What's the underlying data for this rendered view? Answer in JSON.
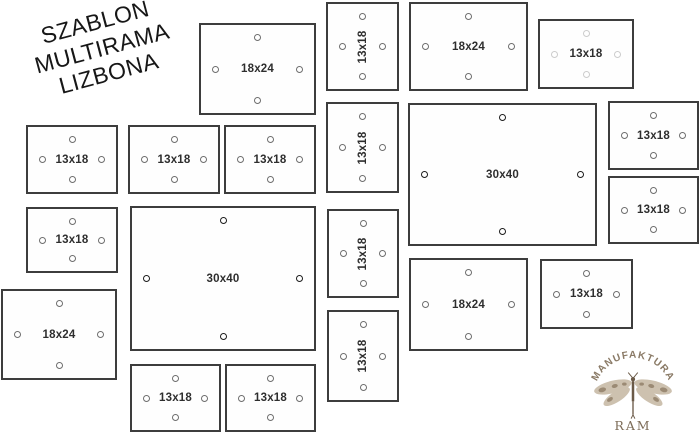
{
  "title": {
    "lines": [
      "SZABLON",
      "MULTIRAMA",
      "LIZBONA"
    ]
  },
  "frames": [
    {
      "id": "A",
      "label": "18x24",
      "x": 199,
      "y": 23,
      "w": 117,
      "h": 92,
      "orient": "h",
      "big": false,
      "light": false
    },
    {
      "id": "B",
      "label": "13x18",
      "x": 326,
      "y": 2,
      "w": 73,
      "h": 89,
      "orient": "v",
      "big": false,
      "light": false
    },
    {
      "id": "C",
      "label": "18x24",
      "x": 409,
      "y": 2,
      "w": 119,
      "h": 89,
      "orient": "h",
      "big": false,
      "light": false
    },
    {
      "id": "D",
      "label": "13x18",
      "x": 538,
      "y": 19,
      "w": 96,
      "h": 70,
      "orient": "h",
      "big": false,
      "light": true
    },
    {
      "id": "E",
      "label": "13x18",
      "x": 26,
      "y": 125,
      "w": 92,
      "h": 69,
      "orient": "h",
      "big": false,
      "light": false
    },
    {
      "id": "F",
      "label": "13x18",
      "x": 128,
      "y": 125,
      "w": 92,
      "h": 69,
      "orient": "h",
      "big": false,
      "light": false
    },
    {
      "id": "G",
      "label": "13x18",
      "x": 224,
      "y": 125,
      "w": 92,
      "h": 69,
      "orient": "h",
      "big": false,
      "light": false
    },
    {
      "id": "H",
      "label": "13x18",
      "x": 326,
      "y": 102,
      "w": 73,
      "h": 91,
      "orient": "v",
      "big": false,
      "light": false
    },
    {
      "id": "I",
      "label": "30x40",
      "x": 408,
      "y": 103,
      "w": 189,
      "h": 143,
      "orient": "h",
      "big": true,
      "light": false
    },
    {
      "id": "J",
      "label": "13x18",
      "x": 608,
      "y": 101,
      "w": 91,
      "h": 69,
      "orient": "h",
      "big": false,
      "light": false
    },
    {
      "id": "K",
      "label": "13x18",
      "x": 608,
      "y": 176,
      "w": 91,
      "h": 68,
      "orient": "h",
      "big": false,
      "light": false
    },
    {
      "id": "L",
      "label": "13x18",
      "x": 26,
      "y": 207,
      "w": 92,
      "h": 66,
      "orient": "h",
      "big": false,
      "light": false
    },
    {
      "id": "M",
      "label": "30x40",
      "x": 130,
      "y": 206,
      "w": 186,
      "h": 145,
      "orient": "h",
      "big": true,
      "light": false
    },
    {
      "id": "N",
      "label": "13x18",
      "x": 327,
      "y": 209,
      "w": 72,
      "h": 89,
      "orient": "v",
      "big": false,
      "light": false
    },
    {
      "id": "P",
      "label": "18x24",
      "x": 1,
      "y": 289,
      "w": 116,
      "h": 91,
      "orient": "h",
      "big": false,
      "light": false
    },
    {
      "id": "Q",
      "label": "18x24",
      "x": 409,
      "y": 258,
      "w": 119,
      "h": 93,
      "orient": "h",
      "big": false,
      "light": false
    },
    {
      "id": "R",
      "label": "13x18",
      "x": 540,
      "y": 259,
      "w": 93,
      "h": 70,
      "orient": "h",
      "big": false,
      "light": false
    },
    {
      "id": "S",
      "label": "13x18",
      "x": 327,
      "y": 310,
      "w": 72,
      "h": 92,
      "orient": "v",
      "big": false,
      "light": false
    },
    {
      "id": "T",
      "label": "13x18",
      "x": 130,
      "y": 364,
      "w": 91,
      "h": 68,
      "orient": "h",
      "big": false,
      "light": false
    },
    {
      "id": "U",
      "label": "13x18",
      "x": 225,
      "y": 364,
      "w": 91,
      "h": 68,
      "orient": "h",
      "big": false,
      "light": false
    }
  ],
  "logo": {
    "arc_text": "MANUFAKTURA",
    "sub_text": "RAM",
    "colors": {
      "text": "#8a7a66",
      "wing": "#cdc1af",
      "wing_spot": "#9b8a74",
      "body": "#6b5a48"
    }
  },
  "colors": {
    "background": "#ffffff",
    "frame_border": "#3d3d3d",
    "hole_stroke": "#6e6e6e",
    "hole_stroke_big": "#1d1d1d",
    "hole_stroke_light": "#cccccc",
    "label_text": "#2e2e2e",
    "title_text": "#171717"
  }
}
